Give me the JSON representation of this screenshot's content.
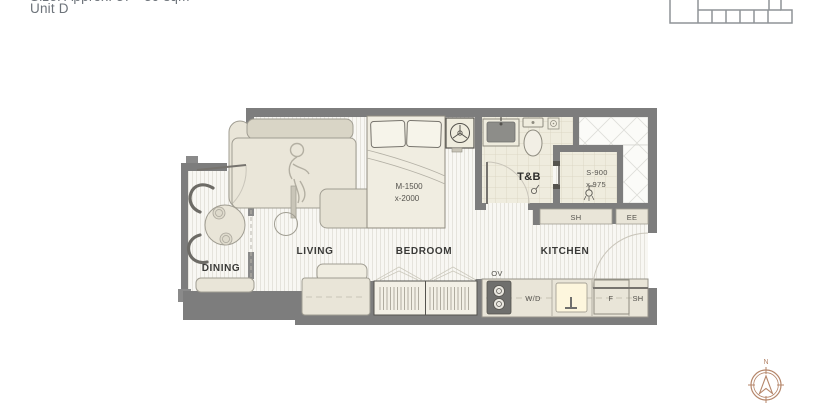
{
  "header": {
    "size_line": "Size: Approx. 37 - 39 sqm",
    "unit_line": "Unit D"
  },
  "plan": {
    "room_labels": {
      "dining": "DINING",
      "living": "LIVING",
      "bedroom": "BEDROOM",
      "kitchen": "KITCHEN",
      "bath": "T&B"
    },
    "dimensions": {
      "bed_width": "M-1500",
      "bed_length": "x-2000",
      "shower_width": "S-900",
      "shower_length": "x 975"
    },
    "fixture_labels": {
      "oven": "OV",
      "washer_dryer": "W/D",
      "fridge": "F",
      "counter_shelf": "SH",
      "strip_shelf": "SH",
      "electrical": "EE"
    }
  },
  "compass": {
    "north": "N"
  },
  "colors": {
    "wall": "#7d7d7d",
    "furniture_fill": "#e9e5d8",
    "floor_stripe": "#e5e3dc",
    "tile_fill": "#efecde",
    "label_text": "#3a3a38",
    "compass_accent": "#b5866a",
    "keyplan_line": "#8f9397"
  }
}
